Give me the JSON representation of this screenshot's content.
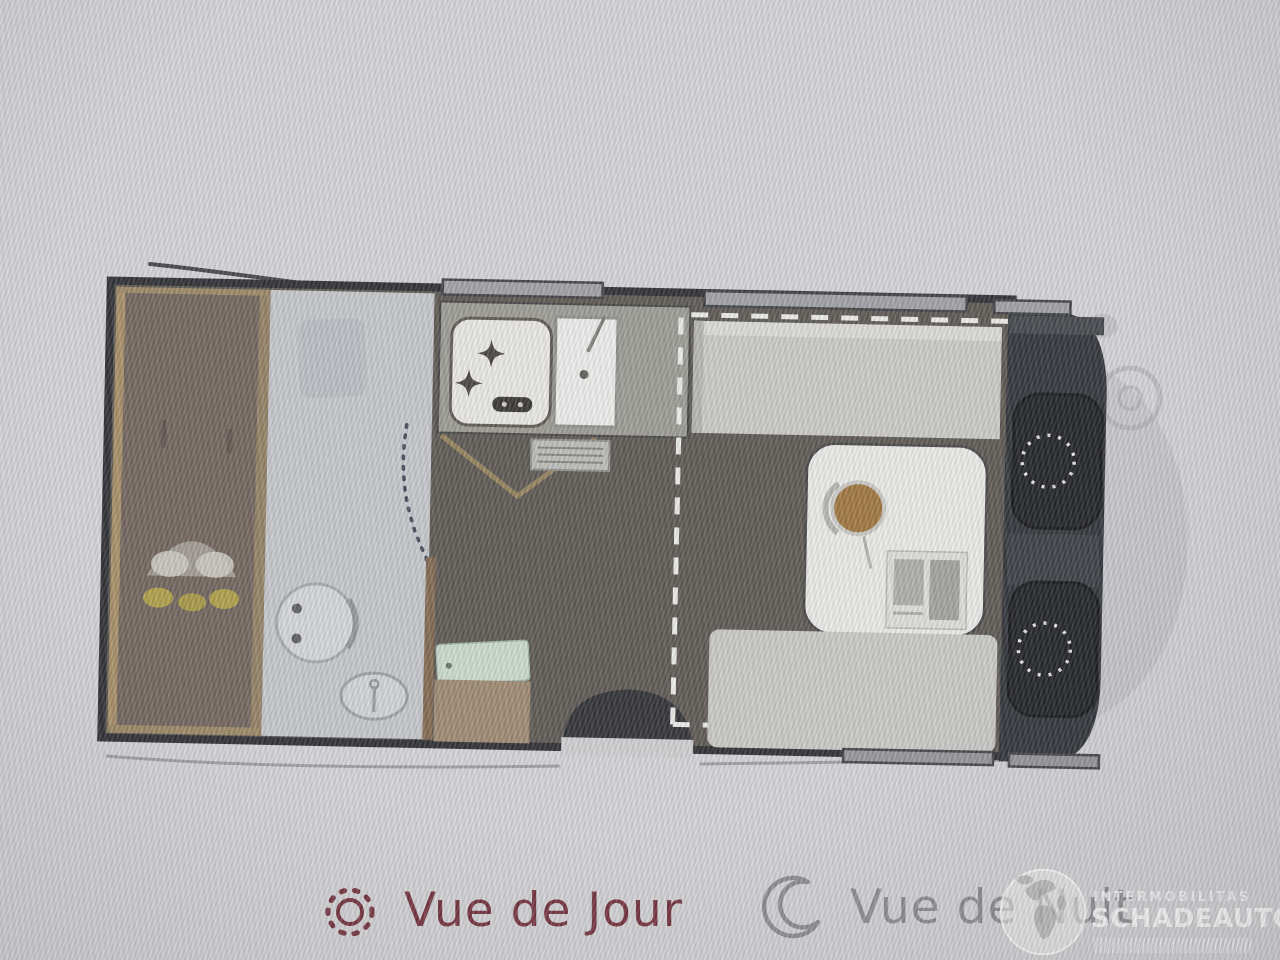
{
  "legend": {
    "day": {
      "label": "Vue de Jour",
      "icon": "sun-icon",
      "color": "#6d2733"
    },
    "night": {
      "label": "Vue de Nuit",
      "icon": "moon-icon",
      "color": "#87888c"
    }
  },
  "watermark": {
    "brand_small": "INTERMOBILITAS",
    "brand_large": "SCHADEAUTOS.NL",
    "icon": "globe-icon"
  },
  "floorplan": {
    "type": "campervan-top-view",
    "regions": [
      "rear-bed",
      "bathroom",
      "kitchen",
      "entry",
      "dinette",
      "cab",
      "vehicle-front"
    ],
    "features": {
      "rear_bed": "bed-with-pillows",
      "bathroom": [
        "toilet",
        "washbasin",
        "dotted-shower-door"
      ],
      "kitchen": [
        "two-burner-stove",
        "kitchen-sink",
        "vent-grate",
        "entry-mat"
      ],
      "dinette": [
        "top-bench",
        "bottom-bench",
        "table-with-bowl-and-map",
        "dashed-dropdown-bed-outline"
      ],
      "cab": [
        "driver-seat",
        "passenger-seat"
      ],
      "windows_top": 3,
      "windows_bottom": 2
    },
    "colors": {
      "floor": "#544f49",
      "bed": "#6a5d54",
      "wood_trim": "#a3895f",
      "bathroom": "#c2c4c8",
      "bench": "#c7c7c4",
      "cab": "#26292e",
      "dashes": "#ebebe8"
    }
  }
}
